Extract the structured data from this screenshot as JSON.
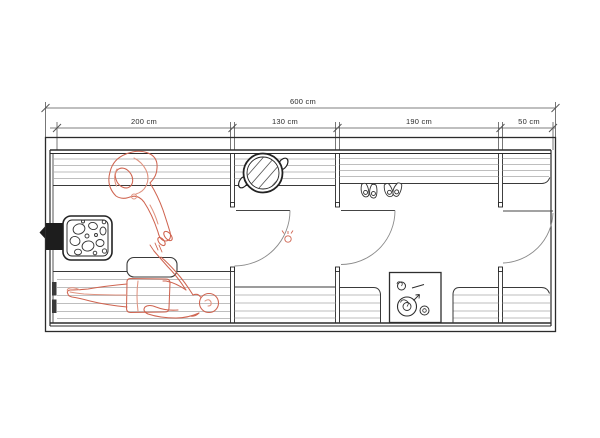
{
  "plan": {
    "type": "sauna-floor-plan",
    "units": "cm",
    "dimensions": {
      "total": {
        "label": "600 cm"
      },
      "segments": [
        {
          "label": "200 cm"
        },
        {
          "label": "130 cm"
        },
        {
          "label": "190 cm"
        },
        {
          "label": "50 cm"
        }
      ]
    },
    "objects": [
      "sauna-heater-with-stones",
      "chimney-outlet",
      "top-bench",
      "lounging-bench",
      "headrest",
      "round-tub",
      "hanging-slippers",
      "stove-cooktop",
      "interior-door",
      "seated-person-sketch",
      "lying-person-sketch",
      "door-handle-sketch"
    ],
    "colors": {
      "ink": "#2e2e2e",
      "wall": "#2b2b2b",
      "bench_stripe": "#a9a9a9",
      "door_arc": "#8a8a8a",
      "dark_fill": "#1d1d1d",
      "sketch_accent": "#cf6450",
      "background": "#ffffff"
    }
  }
}
